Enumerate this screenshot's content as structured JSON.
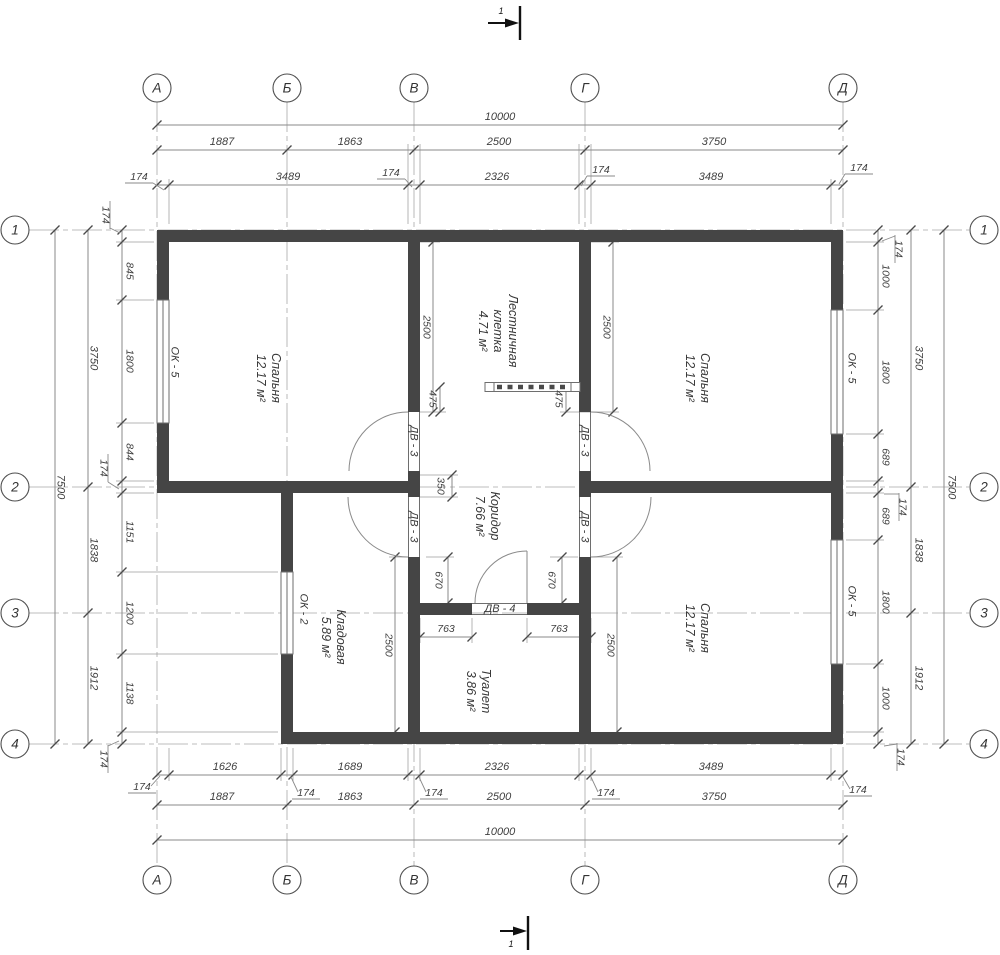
{
  "axes": {
    "cols": [
      "А",
      "Б",
      "В",
      "Г",
      "Д"
    ],
    "rows": [
      "1",
      "2",
      "3",
      "4"
    ]
  },
  "section": {
    "label": "1"
  },
  "dims": {
    "total_w": "10000",
    "total_h": "7500",
    "wall": "174",
    "top2": [
      "1887",
      "1863",
      "2500",
      "3750"
    ],
    "top3": [
      "3489",
      "2326",
      "3489"
    ],
    "bot1": [
      "1626",
      "1689",
      "2326",
      "3489"
    ],
    "bot2": [
      "1887",
      "1863",
      "2500",
      "3750"
    ],
    "left_mid": [
      "3750",
      "1838",
      "1912"
    ],
    "left_in": [
      "845",
      "1800",
      "844",
      "1151",
      "1200",
      "1138"
    ],
    "right_mid": [
      "3750",
      "1838",
      "1912"
    ],
    "right_in": [
      "1000",
      "1800",
      "689",
      "689",
      "1800",
      "1000"
    ],
    "interior": {
      "v2500": "2500",
      "v475": "475",
      "v350": "350",
      "v670": "670",
      "h763": "763"
    }
  },
  "rooms": [
    {
      "name": "Спальня",
      "area": "12.17 м²"
    },
    {
      "name": "Лестничная",
      "name2": "клетка",
      "area": "4.71 м²"
    },
    {
      "name": "Коридор",
      "area": "7.66 м²"
    },
    {
      "name": "Спальня",
      "area": "12.17 м²"
    },
    {
      "name": "Спальня",
      "area": "12.17 м²"
    },
    {
      "name": "Кладовая",
      "area": "5.89 м²"
    },
    {
      "name": "Туалет",
      "area": "3.86 м²"
    }
  ],
  "openings": {
    "ok5": "ОК - 5",
    "ok2": "ОК - 2",
    "dv3": "ДВ - 3",
    "dv4": "ДВ - 4"
  },
  "colors": {
    "wall": "#454545",
    "line": "#8a8a8a",
    "text": "#3f3f3f"
  }
}
